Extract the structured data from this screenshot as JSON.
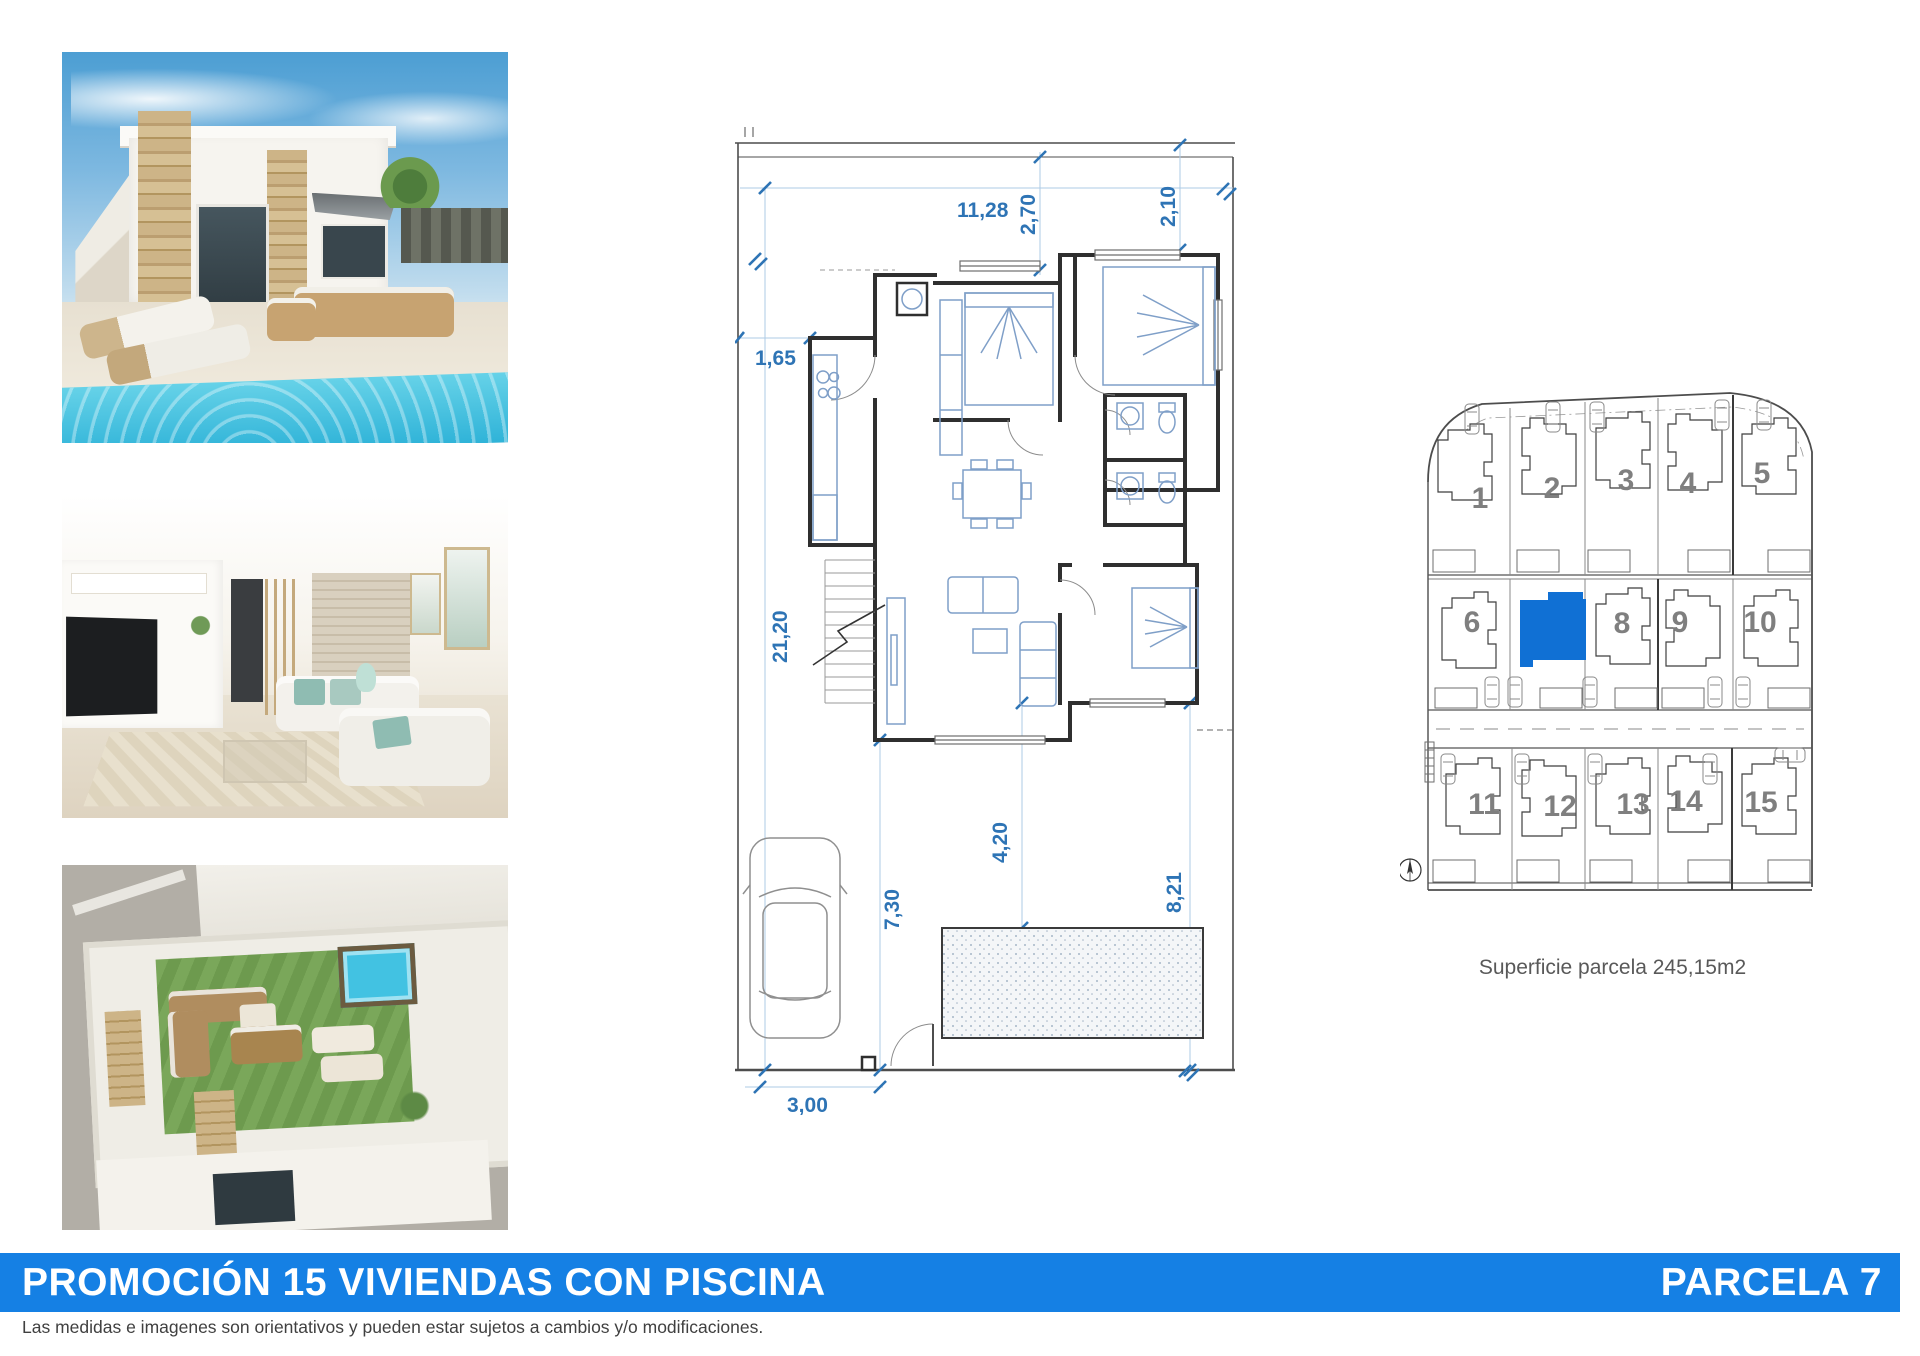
{
  "banner": {
    "title": "PROMOCIÓN 15 VIVIENDAS CON PISCINA",
    "parcela": "PARCELA 7",
    "bg_color": "#1580e4",
    "text_color": "#ffffff"
  },
  "footer": {
    "disclaimer": "Las medidas e imagenes son orientativos y pueden estar sujetos a cambios y/o modificaciones."
  },
  "floorplan": {
    "dim_color": "#2e74b5",
    "dims": {
      "top_width": "11,28",
      "top_depth_1": "2,70",
      "top_depth_2": "2,10",
      "side_offset": "1,65",
      "plot_depth": "21,20",
      "pool_offset": "4,20",
      "front_depth": "7,30",
      "rear_garden": "8,21",
      "drive_width": "3,00",
      "pool_size": "6,00x 2,50"
    }
  },
  "siteplan": {
    "caption": "Superficie parcela 245,15m2",
    "highlight_color": "#1070d4",
    "highlighted_plot": "7",
    "plot_numbers": [
      "1",
      "2",
      "3",
      "4",
      "5",
      "6",
      "8",
      "9",
      "10",
      "11",
      "12",
      "13",
      "14",
      "15"
    ]
  }
}
